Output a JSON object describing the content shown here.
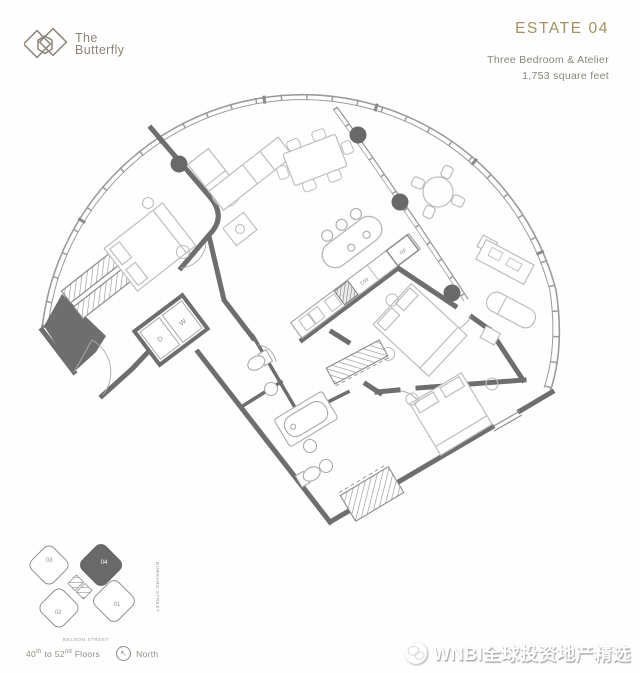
{
  "header": {
    "logo_line1": "The",
    "logo_line2": "Butterfly",
    "estate": "ESTATE 04",
    "subtitle": "Three Bedroom & Atelier",
    "area": "1,753 square feet",
    "accent_color": "#a5915f",
    "text_color": "#87857c",
    "logo_color": "#8c8478"
  },
  "floorplan": {
    "labels": {
      "dryer": "D",
      "washer": "W",
      "dishwasher": "DW",
      "fridge": "RF"
    },
    "wall_color": "#6e6e6e",
    "glass_color": "#9b9b9b",
    "furniture_color": "#bdbdbd",
    "column_color": "#696969"
  },
  "keyplan": {
    "units": [
      {
        "id": "01",
        "highlighted": false
      },
      {
        "id": "02",
        "highlighted": false
      },
      {
        "id": "03",
        "highlighted": false
      },
      {
        "id": "04",
        "highlighted": true
      }
    ],
    "street_bottom": "NELSON STREET",
    "street_right": "BURRARD STREET",
    "floors": {
      "f1": "40",
      "s1": "th",
      "mid": " to ",
      "f2": "52",
      "s2": "nd",
      "tail": " Floors"
    },
    "north": "North",
    "highlight_color": "#696969"
  },
  "watermark": {
    "icon": "wechat-icon",
    "text": "WNBI全球投资地产精选"
  }
}
